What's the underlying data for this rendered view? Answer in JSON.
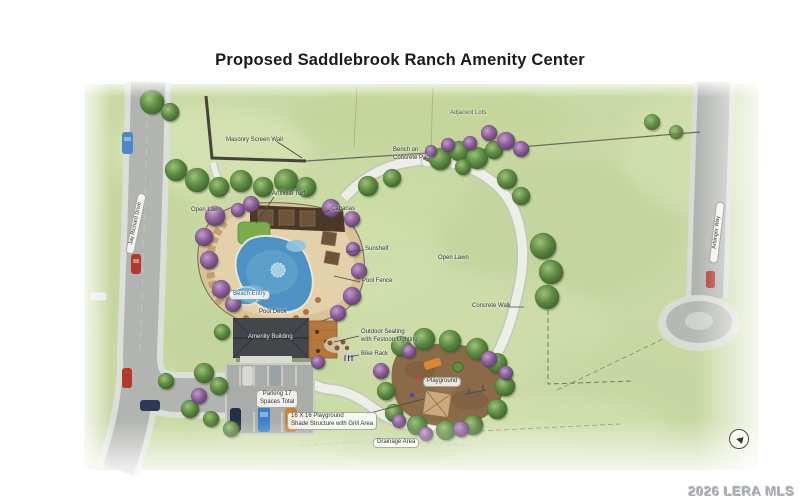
{
  "page": {
    "title": "Proposed Saddlebrook Ranch Amenity Center",
    "watermark": "2026 LERA MLS",
    "north_arrow_glyph": "◀"
  },
  "labels": {
    "adjacent_lots": "Adjacent Lots",
    "masonry_screen_wall": "Masonry Screen Wall",
    "bench_line1": "Bench on",
    "bench_line2": "Concrete Pad",
    "open_lawn_left": "Open Lawn",
    "artificial_turf": "Artificial Turf",
    "cabanas": "Cabanas",
    "sunshelf": "Sunshelf",
    "open_lawn_right": "Open Lawn",
    "pool_fence": "Pool Fence",
    "beach_entry": "Beach Entry",
    "pool_deck": "Pool Deck",
    "concrete_walk": "Concrete Walk",
    "outdoor_seating_line1": "Outdoor Seating",
    "outdoor_seating_line2": "with Festoon Lighting",
    "amenity_building": "Amenity Building",
    "bike_rack": "Bike Rack",
    "playground": "Playground",
    "parking_line1": "Parking 17",
    "parking_line2": "Spaces Total",
    "shade_line1": "16 X 16 Playground",
    "shade_line2": "Shade Structure with Grill Area",
    "drainage_area": "Drainage Area",
    "road_left": "Jay Richard Drive",
    "road_right": "Arbinger Way"
  },
  "colors": {
    "grass": "#c9d8a4",
    "pool_water": "#4d92c2",
    "pool_deck_tan": "#d8c298",
    "road_gray": "#b1b4b0",
    "walk_light": "#edefe7",
    "tree_green": "#5d8a42",
    "tree_purple": "#8a5f96",
    "mulch_brown": "#8a6a48",
    "roof_charcoal": "#43474b",
    "watermark_gray": "#a9aeb4"
  }
}
